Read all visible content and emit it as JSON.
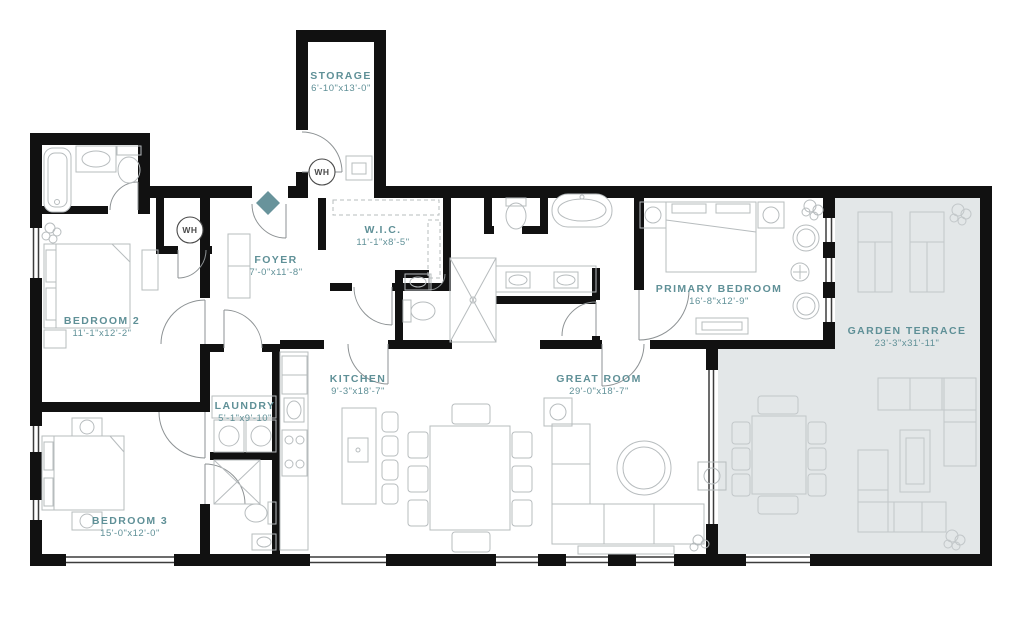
{
  "rooms": {
    "storage": {
      "name": "STORAGE",
      "dims": "6'-10\"x13'-0\""
    },
    "wic": {
      "name": "W.I.C.",
      "dims": "11'-1\"x8'-5\""
    },
    "foyer": {
      "name": "FOYER",
      "dims": "7'-0\"x11'-8\""
    },
    "bedroom2": {
      "name": "BEDROOM 2",
      "dims": "11'-1\"x12'-2\""
    },
    "primary_bedroom": {
      "name": "PRIMARY BEDROOM",
      "dims": "16'-8\"x12'-9\""
    },
    "garden_terrace": {
      "name": "GARDEN TERRACE",
      "dims": "23'-3\"x31'-11\""
    },
    "kitchen": {
      "name": "KITCHEN",
      "dims": "9'-3\"x18'-7\""
    },
    "great_room": {
      "name": "GREAT ROOM",
      "dims": "29'-0\"x18'-7\""
    },
    "laundry": {
      "name": "LAUNDRY",
      "dims": "5'-1\"x9'-10\""
    },
    "bedroom3": {
      "name": "BEDROOM 3",
      "dims": "15'-0\"x12'-0\""
    }
  },
  "markers": {
    "wh_storage": {
      "label": "WH"
    },
    "wh_closet": {
      "label": "WH"
    }
  },
  "colors": {
    "wall": "#111111",
    "label": "#5f9097",
    "terrace": "#e3e7e8",
    "accent": "#68939b",
    "fixture": "#b7bcbe",
    "terrace_fixture": "#c2c7c9",
    "door": "#8d9294",
    "window": "#3c3c3c"
  }
}
